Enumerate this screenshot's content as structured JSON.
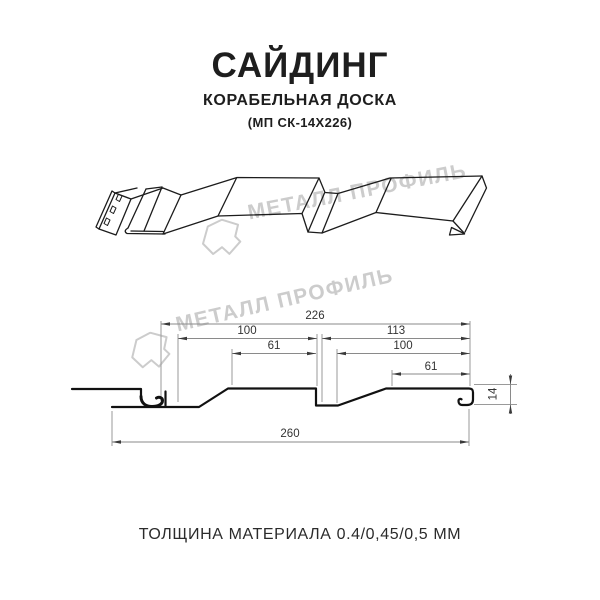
{
  "title": {
    "main": "САЙДИНГ",
    "subtitle": "КОРАБЕЛЬНАЯ ДОСКА",
    "code": "(МП СК-14Х226)"
  },
  "watermark": {
    "text": "МЕТАЛЛ ПРОФИЛЬ",
    "logo_icon": "metall-profil-pentagon-logo",
    "color": "#cccccc"
  },
  "diagram": {
    "type": "technical-profile-drawing",
    "views": [
      "isometric-panel-view",
      "cross-section-with-dimensions"
    ],
    "units": "mm",
    "dimensions": {
      "useful_width": "226",
      "left_module_width": "100",
      "left_top_flat": "61",
      "right_module_width": "113",
      "right_module_flat": "100",
      "right_top_flat": "61",
      "total_width": "260",
      "profile_height": "14"
    }
  },
  "footer": {
    "thickness": "ТОЛЩИНА МАТЕРИАЛА 0.4/0,45/0,5 ММ"
  }
}
